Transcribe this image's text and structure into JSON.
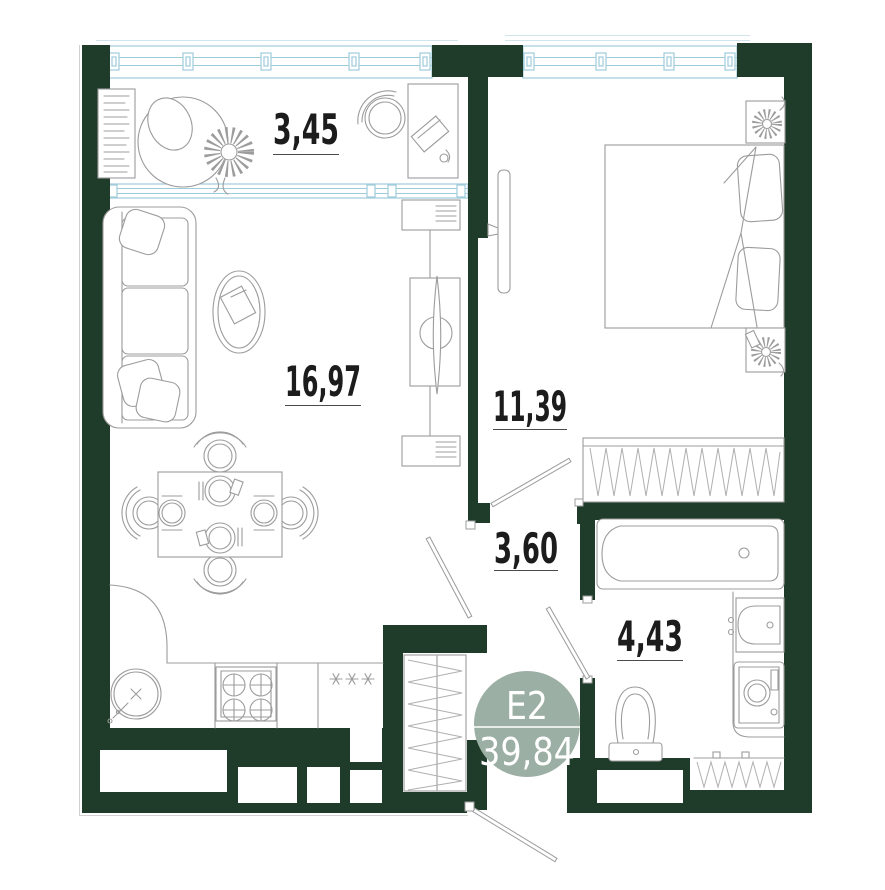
{
  "unit": {
    "label": "E2",
    "total_area": "39,84"
  },
  "rooms": [
    {
      "name": "loggia",
      "area": "3,45"
    },
    {
      "name": "living-kitchen",
      "area": "16,97"
    },
    {
      "name": "bedroom",
      "area": "11,39"
    },
    {
      "name": "hallway",
      "area": "3,60"
    },
    {
      "name": "bathroom",
      "area": "4,43"
    }
  ],
  "colors": {
    "wall": "#1f3c2a",
    "window": "#9fccdb",
    "furniture": "#9c9c9c",
    "label": "#1c1c1c",
    "badge_fill": "#9cafa4",
    "badge_text": "#ffffff"
  }
}
